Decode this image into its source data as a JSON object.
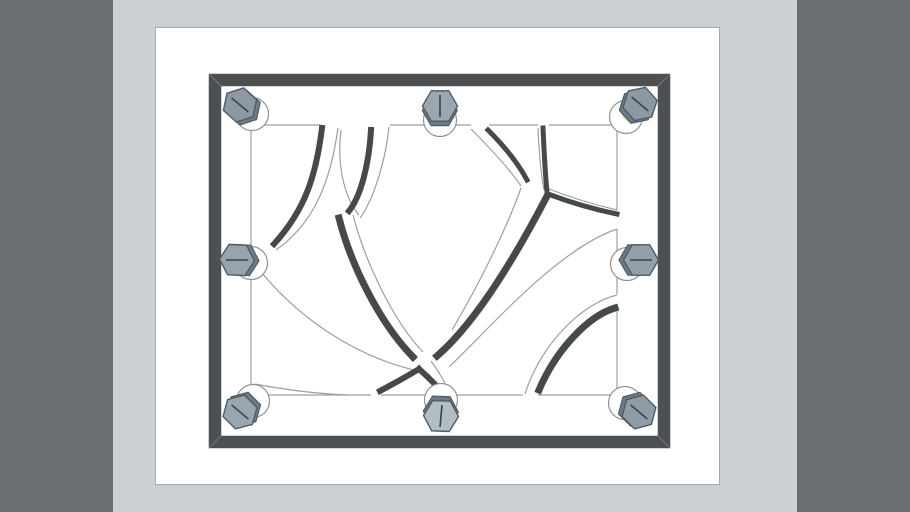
{
  "scene": {
    "size": {
      "w": 910,
      "h": 512
    },
    "colors": {
      "outer_bg": "#6a6e70",
      "viewport_bg": "#cbd0d3",
      "page_bg": "#ffffff",
      "page_border": "#a6abad",
      "frame": "#4d5053",
      "frame_miter": "#73777a",
      "slot_wall": "#46494b",
      "outline": "#9ba0a3",
      "bolt_side": "#6e7b86",
      "bolt_stroke": "#515b64",
      "mark": "#39424a",
      "washer_fill": "#ffffff",
      "washer_stroke": "#8f9396",
      "accent_yellow": "#f0e3ad"
    },
    "bands": {
      "left_width": 113,
      "right_start": 797
    },
    "page": {
      "x": 155,
      "y": 27,
      "w": 565,
      "h": 458
    },
    "frame": {
      "outer": {
        "x": 209,
        "y": 74,
        "w": 461,
        "h": 374
      },
      "thickness": 12,
      "miters": [
        [
          209,
          74,
          221,
          86
        ],
        [
          670,
          74,
          658,
          86
        ],
        [
          209,
          448,
          221,
          436
        ],
        [
          670,
          448,
          658,
          436
        ]
      ]
    },
    "panel_center": {
      "x": 434,
      "y": 261
    },
    "panel_edges": [
      [
        251,
        125,
        320,
        125
      ],
      [
        390,
        125,
        471,
        125
      ],
      [
        489,
        125,
        538,
        125
      ],
      [
        549,
        125,
        617,
        125
      ],
      [
        251,
        395,
        371,
        395
      ],
      [
        381,
        395,
        439,
        395
      ],
      [
        452,
        395,
        523,
        395
      ],
      [
        538,
        395,
        617,
        395
      ],
      [
        251,
        125,
        251,
        395
      ],
      [
        617,
        125,
        617,
        210
      ],
      [
        617,
        229,
        617,
        294
      ],
      [
        617,
        309,
        617,
        395
      ]
    ],
    "outline_curves": [
      "M338,128 C331,178 316,222 276,250",
      "M341,130 C337,162 343,196 359,215",
      "M389,127 C385,165 372,202 360,218",
      "M353,215 C364,258 392,320 423,352",
      "M431,361 C438,371 445,381 448,391",
      "M254,263 C296,318 356,357 418,371",
      "M255,384 C292,391 320,394 348,395",
      "M617,229 C558,249 492,326 449,367",
      "M549,189 C572,198 596,205 617,210",
      "M538,128 C539,152 541,174 544,190",
      "M471,129 C491,149 510,170 521,186",
      "M521,188 C509,222 484,276 452,330",
      "M617,295 C583,303 541,343 525,394",
      "M617,310 C589,317 558,351 540,392"
    ],
    "wall_curves": [
      {
        "d": "M322,128 C316,176 305,210 274,244",
        "w": 6
      },
      {
        "d": "M371,130 C369,164 361,196 349,211",
        "w": 6
      },
      {
        "d": "M339,218 C350,262 378,321 413,357",
        "w": 7
      },
      {
        "d": "M419,369 C427,376 435,384 441,391",
        "w": 6
      },
      {
        "d": "M546,198 C523,242 481,318 437,356",
        "w": 7
      },
      {
        "d": "M419,369 C406,377 391,385 380,391",
        "w": 6
      },
      {
        "d": "M543,128 C544,150 545,172 547,192",
        "w": 5
      },
      {
        "d": "M548,194 C572,203 597,210 617,214",
        "w": 5
      },
      {
        "d": "M488,130 C504,146 518,163 527,180",
        "w": 5
      },
      {
        "d": "M615,308 C588,316 556,350 539,390",
        "w": 7
      }
    ],
    "bolt_geometry": {
      "hex_r": 17.5,
      "washer_r": 16.5,
      "yellow_r": 10.5,
      "mark_len": 11,
      "depth_offset": 4.5
    },
    "bolts": [
      {
        "id": "top-left",
        "x": 240,
        "y": 105,
        "wx": 252,
        "wy": 114,
        "rot": -18,
        "mark": 40,
        "face": "#8c98a3",
        "yellow": true
      },
      {
        "id": "top-center",
        "x": 440,
        "y": 106,
        "wx": 440,
        "wy": 120,
        "rot": 0,
        "mark": 90,
        "face": "#9aa6b0",
        "yellow": true
      },
      {
        "id": "top-right",
        "x": 640,
        "y": 104,
        "wx": 626,
        "wy": 117,
        "rot": -12,
        "mark": 40,
        "face": "#8c99a4",
        "yellow": true
      },
      {
        "id": "mid-left",
        "x": 237,
        "y": 260,
        "wx": 251,
        "wy": 263,
        "rot": 3,
        "mark": 0,
        "face": "#97a3ad",
        "yellow": true
      },
      {
        "id": "mid-right",
        "x": 641,
        "y": 260,
        "wx": 627,
        "wy": 264,
        "rot": 0,
        "mark": 0,
        "face": "#93a0ab",
        "yellow": true
      },
      {
        "id": "bottom-left",
        "x": 240,
        "y": 412,
        "wx": 253,
        "wy": 401,
        "rot": -15,
        "mark": 40,
        "face": "#9aa6af",
        "yellow": true
      },
      {
        "id": "bottom-center",
        "x": 441,
        "y": 416,
        "wx": 441,
        "wy": 400,
        "rot": 2,
        "mark": 95,
        "face": "#b3bdc4",
        "yellow": false
      },
      {
        "id": "bottom-right",
        "x": 639,
        "y": 412,
        "wx": 625,
        "wy": 403,
        "rot": -15,
        "mark": 40,
        "face": "#8f9ca7",
        "yellow": true
      }
    ]
  }
}
